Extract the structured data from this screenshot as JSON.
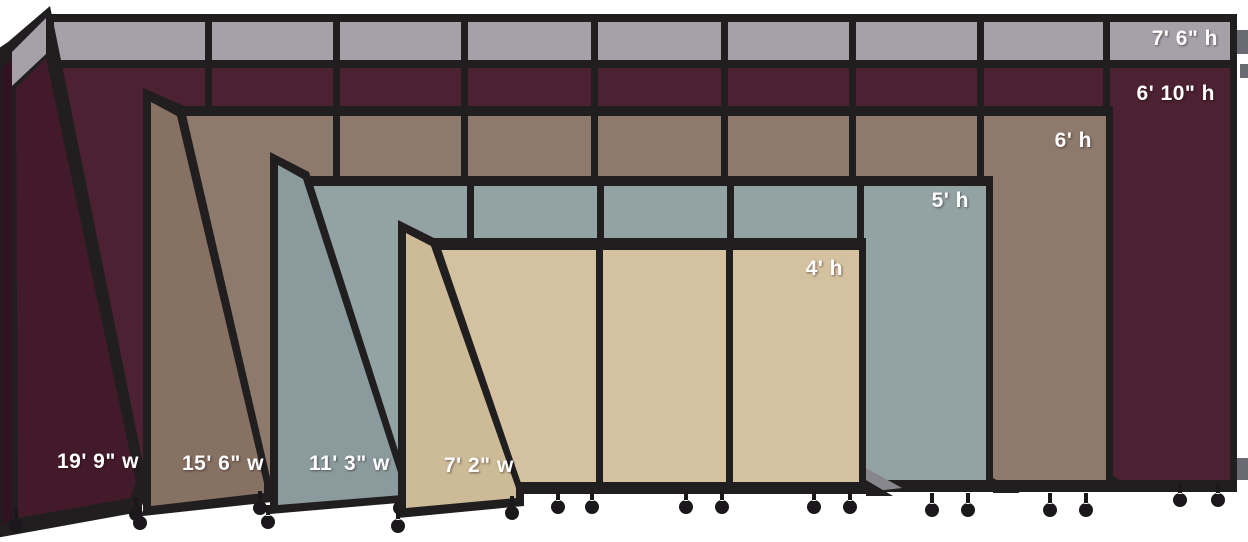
{
  "sizes": {
    "heights": [
      "7' 6\" h",
      "6' 10\" h",
      "6' h",
      "5' h",
      "4' h"
    ],
    "widths": [
      "19' 9\" w",
      "15' 6\" w",
      "11' 3\" w",
      "7' 2\" w"
    ]
  },
  "colors": {
    "background": "#ffffff",
    "frame": "#211e20",
    "grayBand": "#a5a1a9",
    "maroon": "#4c2131",
    "maroonDark": "#431a2a",
    "maroonEdge": "#301220",
    "brown": "#8e7a6c",
    "brownDark": "#877163",
    "slate": "#93a3a4",
    "slateDark": "#8b9b9d",
    "beige": "#d4c1a0",
    "beigeDark": "#cdba96",
    "bracket": "#6a6a72",
    "plate": "#86868c",
    "caster": "#1a181b",
    "labelText": "#ffffff"
  }
}
